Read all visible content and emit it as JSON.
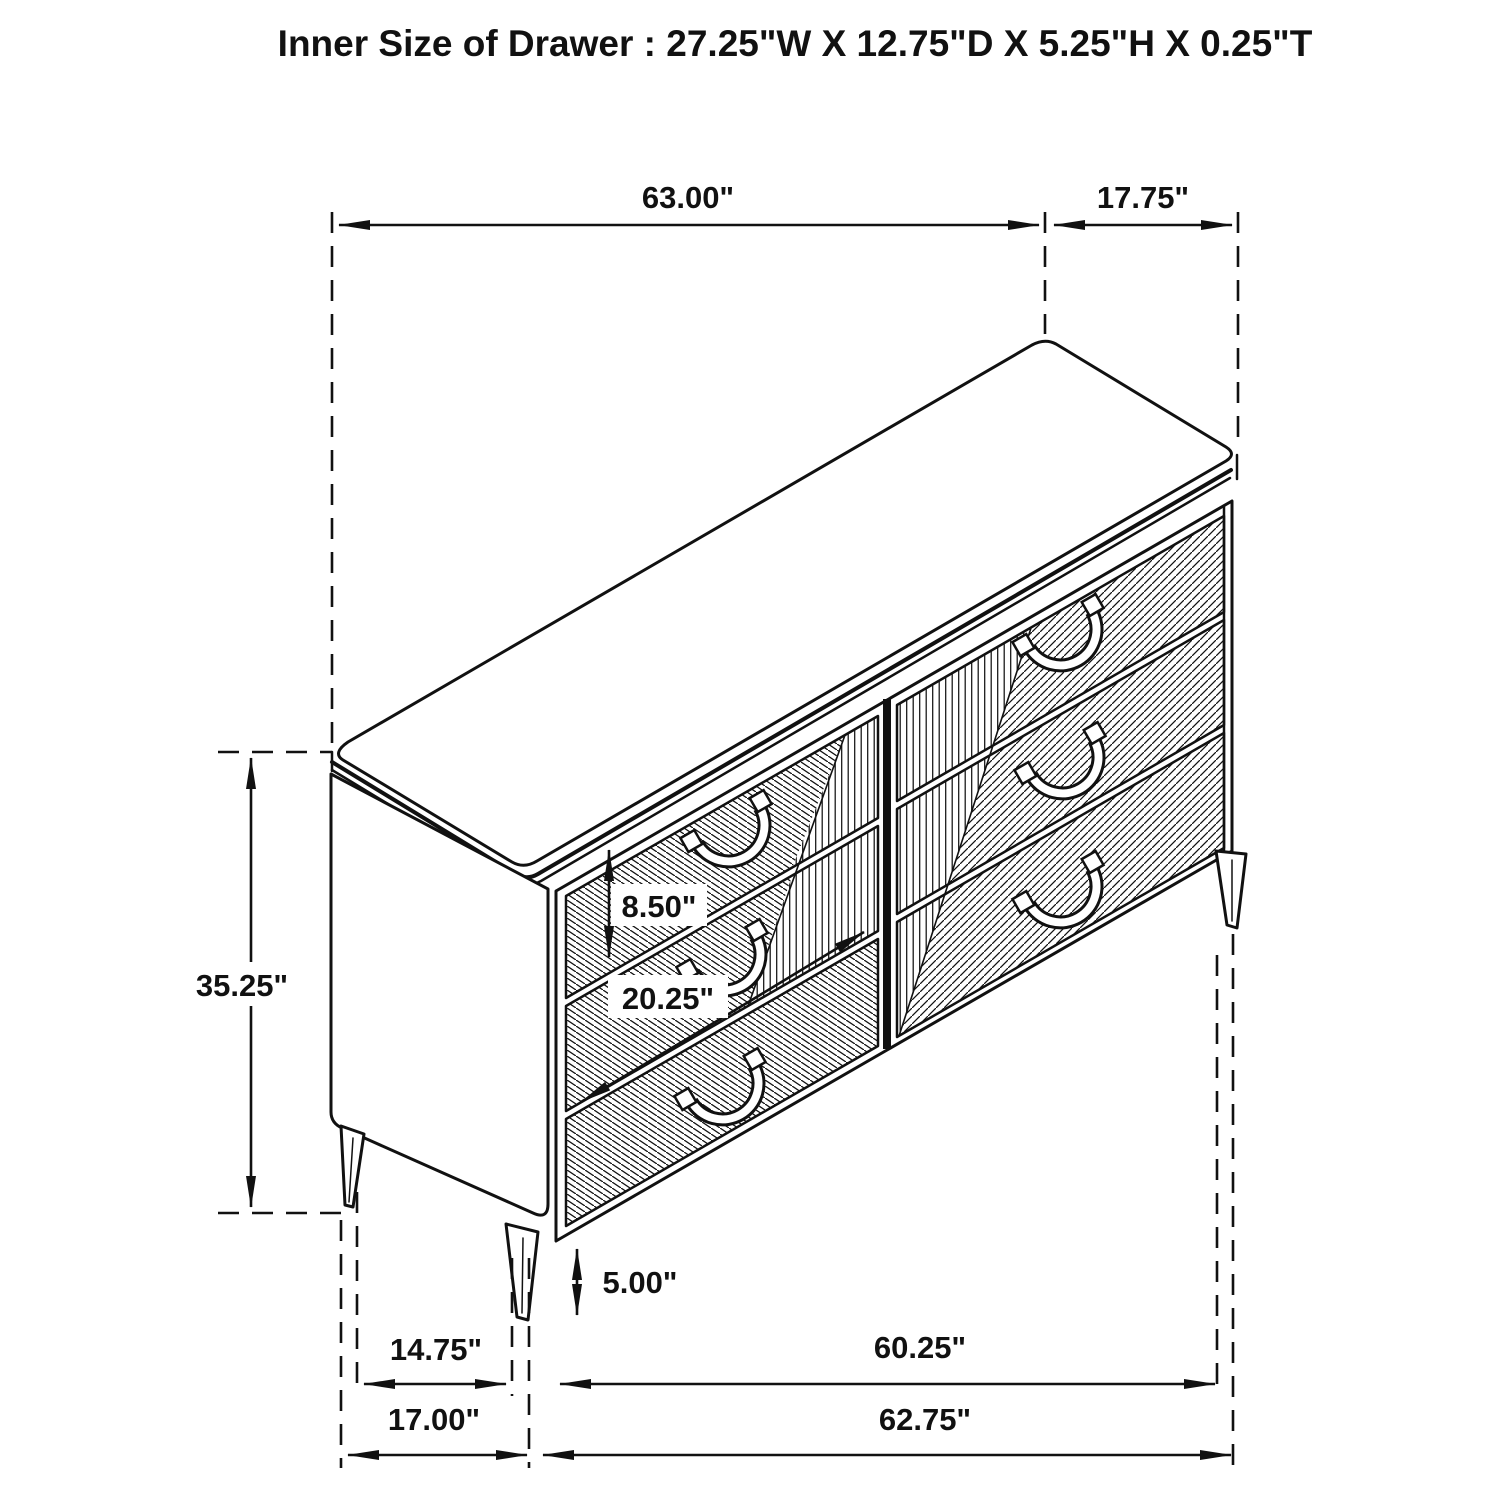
{
  "title": "Inner Size of Drawer : 27.25\"W X 12.75\"D X 5.25\"H X 0.25\"T",
  "figure": {
    "type": "isometric technical line drawing",
    "subject": "six-drawer dresser with chevron ribbed drawer fronts and tapered metal legs",
    "drawer_count": 6,
    "handle_count": 6
  },
  "colors": {
    "line": "#111111",
    "background": "#ffffff"
  },
  "dimensions": {
    "top_width": "63.00\"",
    "top_depth": "17.75\"",
    "overall_height": "35.25\"",
    "drawer_front_height": "8.50\"",
    "drawer_row_span": "20.25\"",
    "leg_height": "5.00\"",
    "left_leg_inset": "14.75\"",
    "leg_span": "60.25\"",
    "left_section_width": "17.00\"",
    "base_width": "62.75\""
  }
}
